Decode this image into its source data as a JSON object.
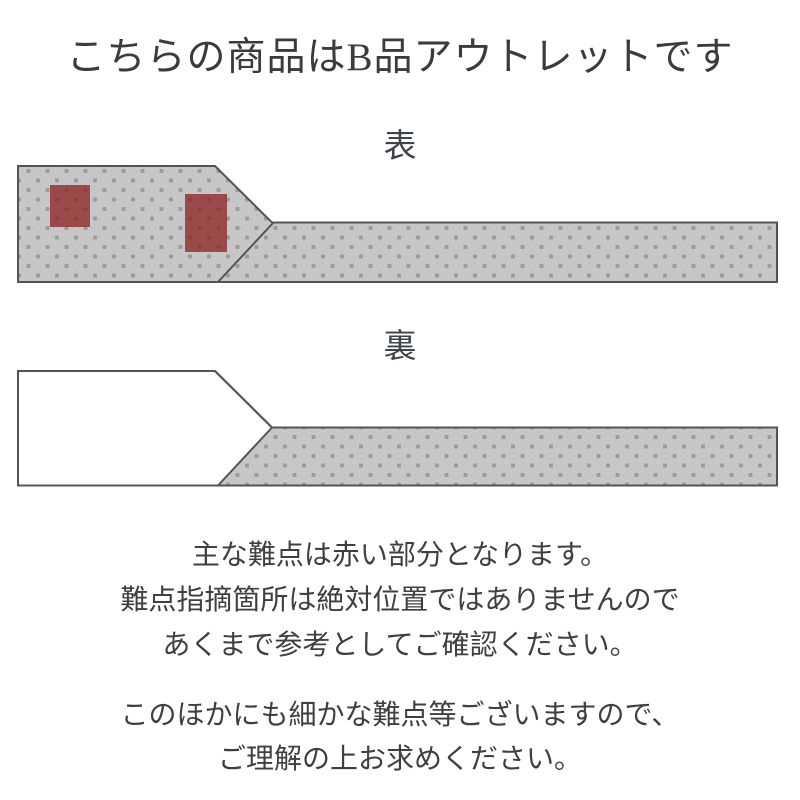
{
  "title": "こちらの商品はB品アウトレットです",
  "diagrams": {
    "front": {
      "label": "表",
      "defect_markers": [
        {
          "x": 50,
          "y": 185,
          "width": 40,
          "height": 42
        },
        {
          "x": 185,
          "y": 194,
          "width": 42,
          "height": 58
        }
      ]
    },
    "back": {
      "label": "裏",
      "defect_markers": []
    }
  },
  "notes": {
    "primary_lines": [
      "主な難点は赤い部分となります。",
      "難点指摘箇所は絶対位置ではありませんので",
      "あくまで参考としてご確認ください。"
    ],
    "secondary_lines": [
      "このほかにも細かな難点等ございますので、",
      "ご理解の上お求めください。"
    ]
  },
  "colors": {
    "defect_marker": "#8a1a1a",
    "fabric_base": "#9b9b9b",
    "fabric_ring": "#c7c7c7",
    "outline": "#545454",
    "text": "#3e3e3e"
  }
}
